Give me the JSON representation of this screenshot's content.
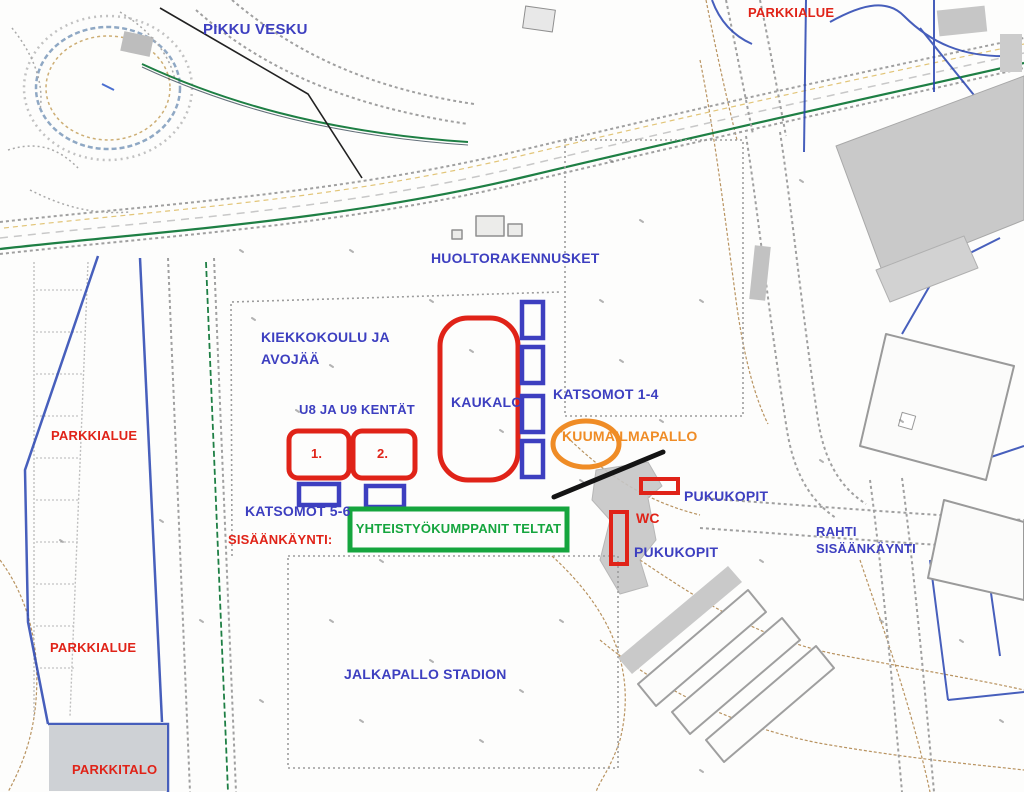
{
  "colors": {
    "red": "#e02318",
    "blue": "#3d3fc0",
    "green": "#15a53e",
    "orange": "#ef8c26",
    "black": "#141414"
  },
  "labels": {
    "pikku_vesku": "PIKKU VESKU",
    "parkkialue_top": "PARKKIALUE",
    "huoltorakennukset": "HUOLTORAKENNUSKET",
    "kiekkokoulu_line1": "KIEKKOKOULU JA",
    "kiekkokoulu_line2": "AVOJÄÄ",
    "u8_u9": "U8 JA U9 KENTÄT",
    "kaukalo": "KAUKALO",
    "katsomot_1_4": "KATSOMOT 1-4",
    "kuumailmapallo": "KUUMAILMAPALLO",
    "kentta_1": "1.",
    "kentta_2": "2.",
    "katsomot_5_6": "KATSOMOT 5-6",
    "sisaankaynti": "SISÄÄNKÄYNTI:",
    "yhteistyokumppanit": "YHTEISTYÖKUMPPANIT TELTAT",
    "wc": "WC",
    "pukukopit_upper": "PUKUKOPIT",
    "pukukopit_lower": "PUKUKOPIT",
    "rahti_line1": "RAHTI",
    "rahti_line2": "SISÄÄNKÄYNTI",
    "parkkialue_left": "PARKKIALUE",
    "parkkialue_left_lower": "PARKKIALUE",
    "parkkitalo": "PARKKITALO",
    "jalkapallo_stadion": "JALKAPALLO STADION"
  }
}
